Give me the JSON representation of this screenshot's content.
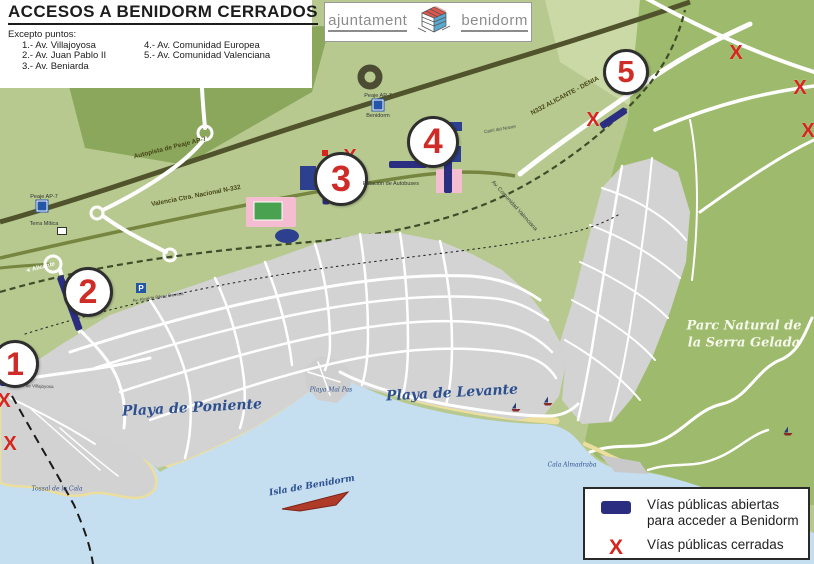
{
  "title": "ACCESOS A BENIDORM CERRADOS",
  "exceptions": {
    "heading": "Excepto puntos:",
    "items": [
      "1.- Av. Villajoyosa",
      "2.- Av. Juan Pablo II",
      "3.- Av. Beniarda",
      "4.- Av. Comunidad Europea",
      "5.- Av. Comunidad Valenciana"
    ]
  },
  "logo": {
    "left": "ajuntament",
    "right": "benidorm"
  },
  "legend": {
    "open_line1": "Vías públicas abiertas",
    "open_line2": "para acceder a Benidorm",
    "x_symbol": "X",
    "closed": "Vías públicas cerradas"
  },
  "map": {
    "colors": {
      "open_segment": "#2a2d80",
      "closed_mark": "#d6251f",
      "point_number": "#cf2b27",
      "sea": "#c5def0",
      "land": "#b7c98f",
      "urban": "#d3d3d3",
      "park": "#9eba6c",
      "beach": "#ecdf9e"
    },
    "access_points": [
      {
        "number": "1",
        "x": 15,
        "y": 364,
        "r": 24
      },
      {
        "number": "2",
        "x": 88,
        "y": 292,
        "r": 25
      },
      {
        "number": "3",
        "x": 341,
        "y": 179,
        "r": 27
      },
      {
        "number": "4",
        "x": 433,
        "y": 142,
        "r": 26
      },
      {
        "number": "5",
        "x": 626,
        "y": 72,
        "r": 23
      }
    ],
    "closed_marks": [
      {
        "x": 350,
        "y": 157
      },
      {
        "x": 593,
        "y": 120
      },
      {
        "x": 736,
        "y": 53
      },
      {
        "x": 800,
        "y": 88
      },
      {
        "x": 808,
        "y": 131
      },
      {
        "x": 4,
        "y": 401
      },
      {
        "x": 10,
        "y": 444
      }
    ],
    "open_segments": [
      {
        "x": 0,
        "y": 382,
        "len": 23,
        "angle": 0,
        "w": 7
      },
      {
        "x": 60,
        "y": 276,
        "len": 57,
        "angle": 70,
        "w": 7
      },
      {
        "x": 326,
        "y": 163,
        "len": 41,
        "angle": 90,
        "w": 7
      },
      {
        "x": 389,
        "y": 164,
        "len": 38,
        "angle": 0,
        "w": 7
      },
      {
        "x": 448,
        "y": 151,
        "len": 42,
        "angle": 90,
        "w": 8
      },
      {
        "x": 601,
        "y": 126,
        "len": 30,
        "angle": -34,
        "w": 7
      }
    ],
    "labels": [
      {
        "id": "playa-poniente",
        "text": "Playa de Poniente",
        "x": 192,
        "y": 408,
        "rot": -3,
        "cls": "water-lg"
      },
      {
        "id": "playa-levante",
        "text": "Playa de Levante",
        "x": 452,
        "y": 393,
        "rot": -3,
        "cls": "water-lg"
      },
      {
        "id": "parc-natural-1",
        "text": "Parc Natural de",
        "x": 744,
        "y": 326,
        "rot": 0,
        "cls": "park"
      },
      {
        "id": "parc-natural-2",
        "text": "la Serra Gelada",
        "x": 744,
        "y": 343,
        "rot": 0,
        "cls": "park"
      },
      {
        "id": "isla-benidorm",
        "text": "Isla de Benidorm",
        "x": 312,
        "y": 486,
        "rot": -10,
        "cls": "water-sm"
      },
      {
        "id": "playa-mal-pas",
        "text": "Playa Mal Pas",
        "x": 331,
        "y": 390,
        "rot": 0,
        "cls": "water-xs"
      },
      {
        "id": "tossal-de-la-cala",
        "text": "Tossal de la Cala",
        "x": 57,
        "y": 489,
        "rot": 0,
        "cls": "water-xs"
      },
      {
        "id": "cala-almadraba",
        "text": "Cala Almadraba",
        "x": 572,
        "y": 465,
        "rot": 0,
        "cls": "water-xs"
      },
      {
        "id": "autopista-ap7",
        "text": "Autopista de Peaje AP-7",
        "x": 170,
        "y": 148,
        "rot": -14,
        "cls": "road"
      },
      {
        "id": "nacional-n332",
        "text": "Valencia Ctra. Nacional N-332",
        "x": 196,
        "y": 196,
        "rot": -11,
        "cls": "road"
      },
      {
        "id": "n332-alicante-denia",
        "text": "N332 ALICANTE - DENIA",
        "x": 565,
        "y": 96,
        "rot": -28,
        "cls": "road"
      },
      {
        "id": "av-comunidad-valenciana",
        "text": "Av. Comunidad Valenciana",
        "x": 514,
        "y": 206,
        "rot": 48,
        "cls": "road-xs"
      },
      {
        "id": "estacion-autobuses",
        "text": "Estación de Autobuses",
        "x": 391,
        "y": 184,
        "rot": 0,
        "cls": "poi"
      },
      {
        "id": "peaje-ap7-terra",
        "text": "Peaje AP-7",
        "x": 44,
        "y": 197,
        "rot": 0,
        "cls": "poi"
      },
      {
        "id": "terra-mitica",
        "text": "Terra Mítica",
        "x": 44,
        "y": 224,
        "rot": 0,
        "cls": "poi"
      },
      {
        "id": "peaje-ap7-benidorm",
        "text": "Peaje AP-7",
        "x": 378,
        "y": 96,
        "rot": 0,
        "cls": "poi"
      },
      {
        "id": "peaje-benidorm-2",
        "text": "Benidorm",
        "x": 378,
        "y": 116,
        "rot": 0,
        "cls": "poi"
      },
      {
        "id": "alicante-sign",
        "text": "◄ Alicante",
        "x": 40,
        "y": 268,
        "rot": -14,
        "cls": "sign"
      },
      {
        "id": "av-villajoyosa-road",
        "text": "Av. de Villajoyosa",
        "x": 36,
        "y": 386,
        "rot": 2,
        "cls": "street"
      },
      {
        "id": "av-alcalde",
        "text": "Av. Alcalde Pérez Devesa",
        "x": 158,
        "y": 297,
        "rot": -8,
        "cls": "street"
      },
      {
        "id": "cami-del-notxer",
        "text": "Camí del Notxer",
        "x": 500,
        "y": 129,
        "rot": -10,
        "cls": "street"
      }
    ],
    "poi_icons": [
      {
        "id": "toll-terra-mitica",
        "type": "toll",
        "x": 42,
        "y": 206
      },
      {
        "id": "toll-benidorm",
        "type": "toll",
        "x": 378,
        "y": 105
      },
      {
        "id": "parking",
        "type": "p",
        "x": 141,
        "y": 288,
        "glyph": "P"
      },
      {
        "id": "tram-station",
        "type": "tram",
        "x": 62,
        "y": 231
      }
    ],
    "boats": [
      {
        "x": 516,
        "y": 408
      },
      {
        "x": 548,
        "y": 402
      },
      {
        "x": 788,
        "y": 432
      }
    ]
  }
}
